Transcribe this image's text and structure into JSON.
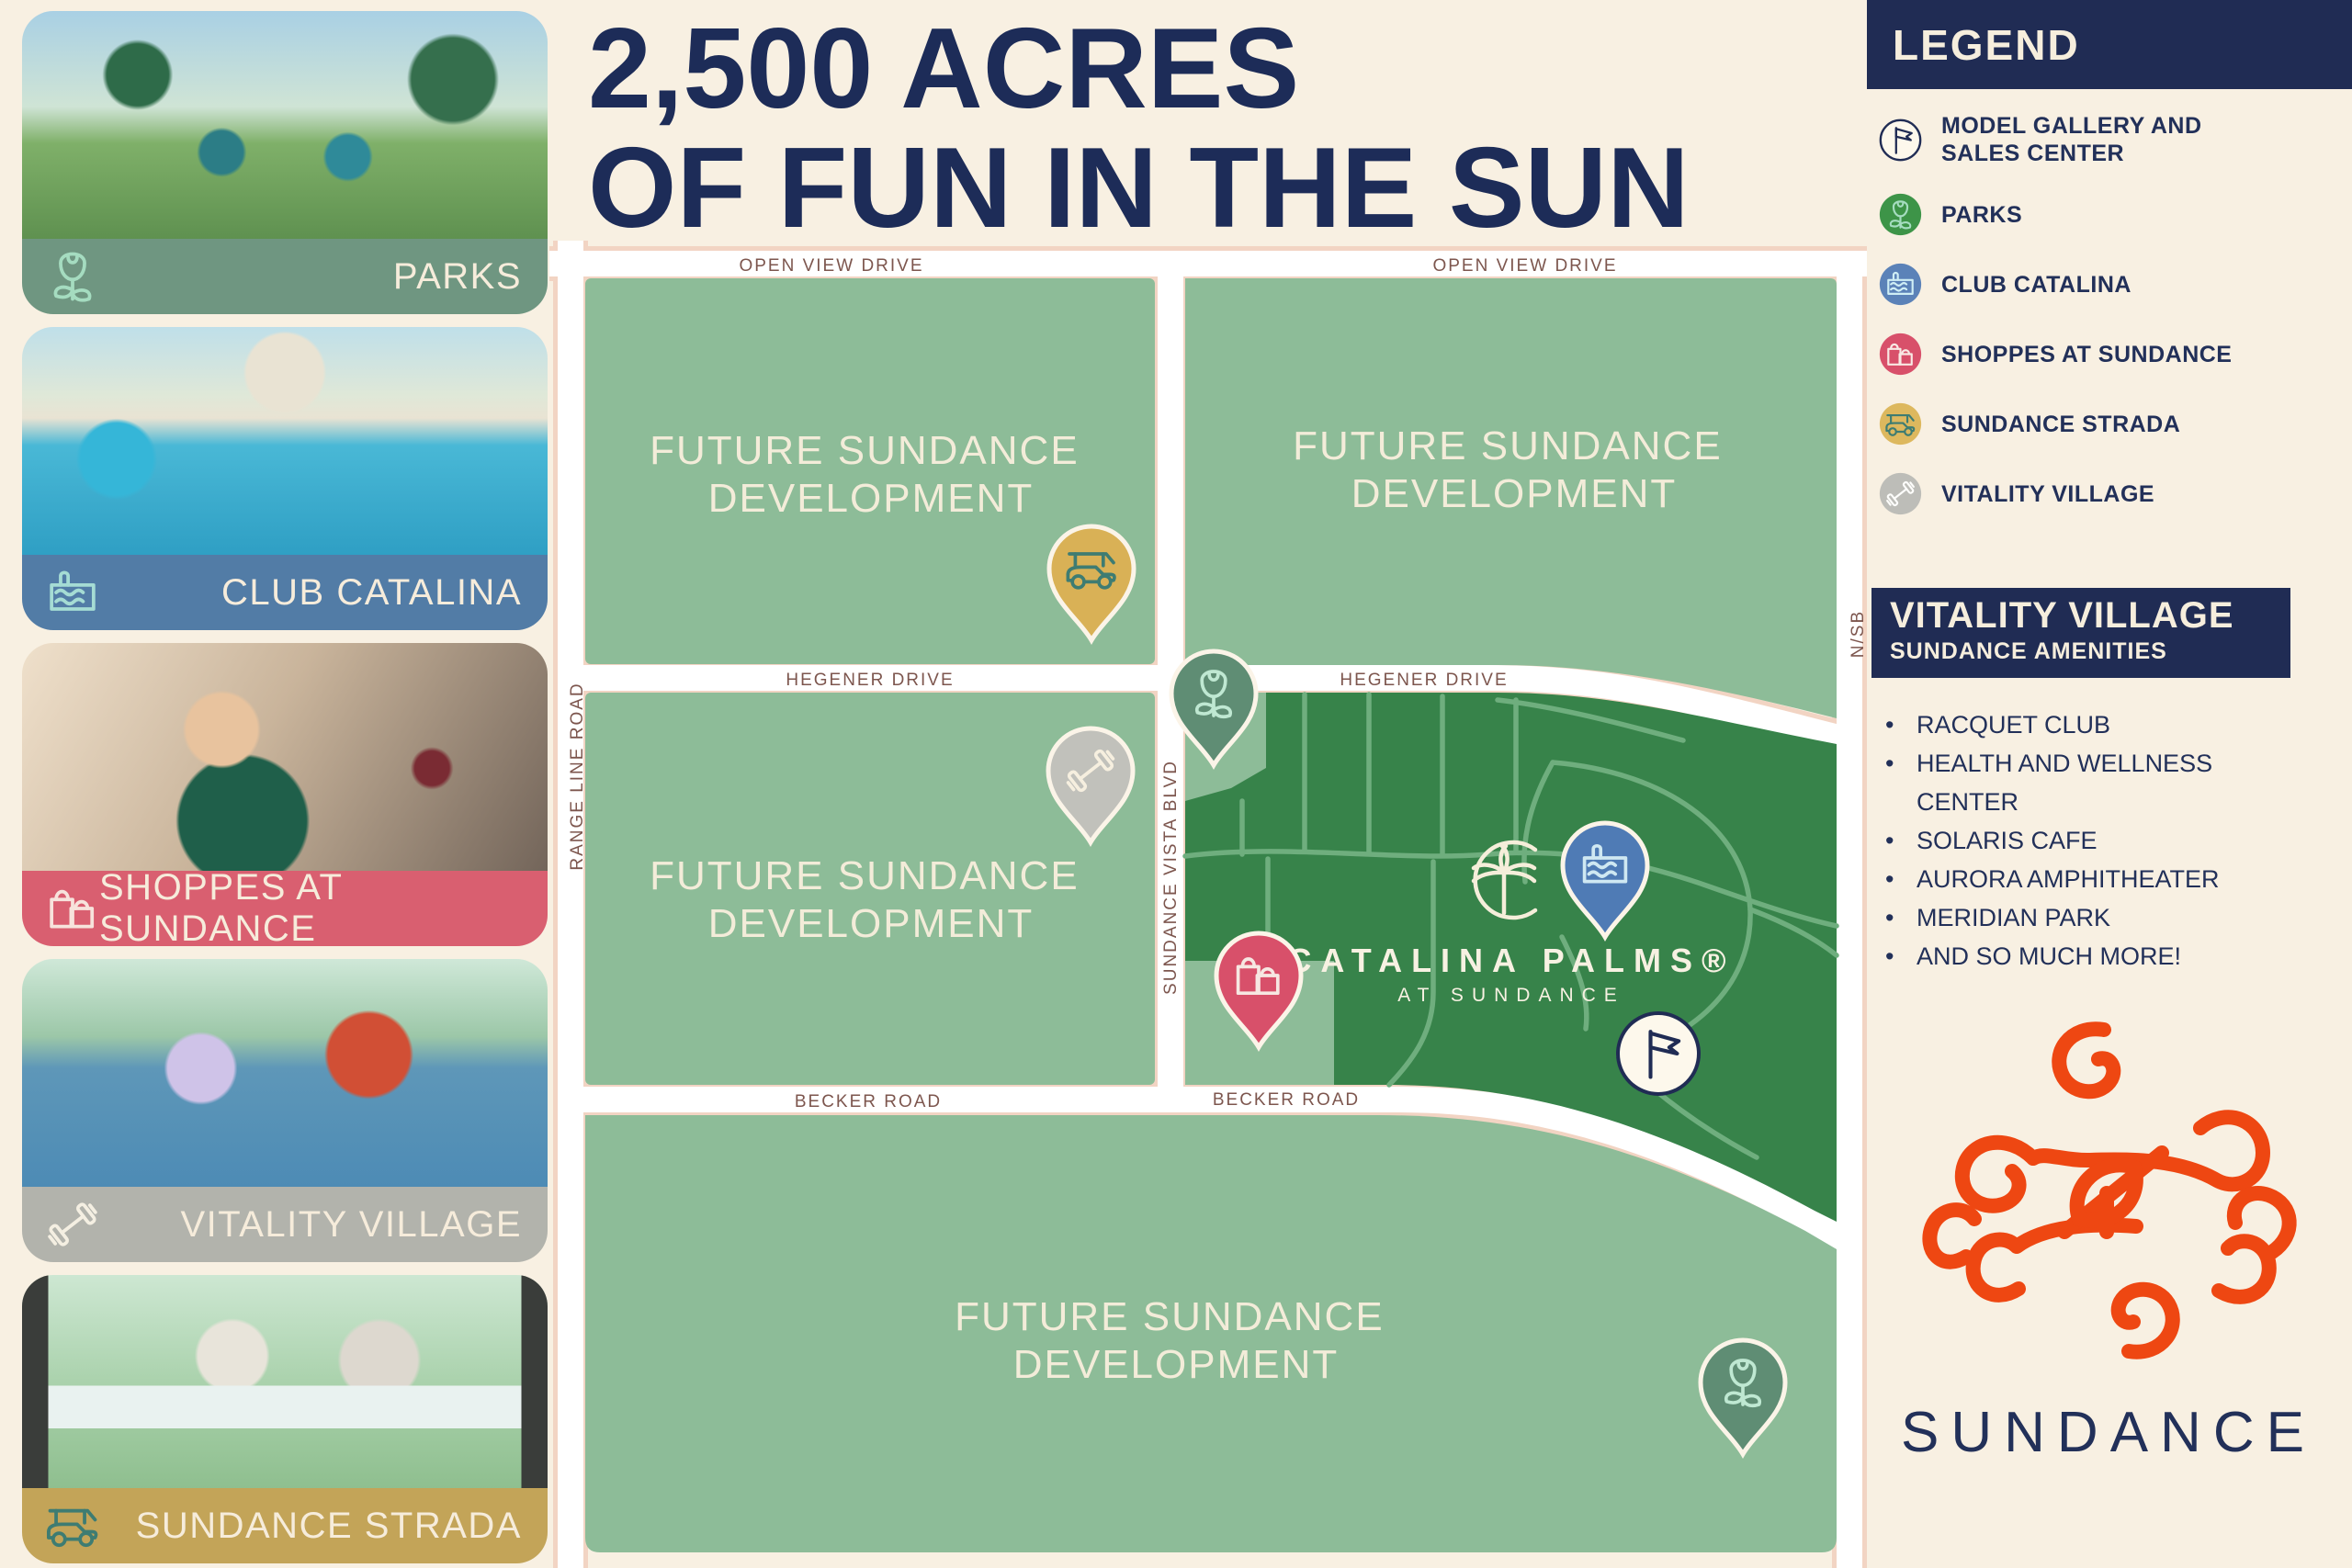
{
  "title": {
    "line1": "2,500 ACRES",
    "line2": "OF FUN IN THE SUN"
  },
  "cards": [
    {
      "label": "PARKS",
      "icon": "flower-icon",
      "color": "#6f9681"
    },
    {
      "label": "CLUB CATALINA",
      "icon": "pool-icon",
      "color": "#527ca6"
    },
    {
      "label": "SHOPPES AT SUNDANCE",
      "icon": "shopping-bags-icon",
      "color": "#d95f70"
    },
    {
      "label": "VITALITY VILLAGE",
      "icon": "dumbbell-icon",
      "color": "#b2b3ac"
    },
    {
      "label": "SUNDANCE STRADA",
      "icon": "golf-cart-icon",
      "color": "#c3a458"
    }
  ],
  "map": {
    "roads": {
      "open_view": "OPEN VIEW DRIVE",
      "hegener": "HEGENER DRIVE",
      "becker": "BECKER ROAD",
      "range_line": "RANGE LINE ROAD",
      "sundance_vista": "SUNDANCE VISTA BLVD",
      "nsb": "N/SB"
    },
    "parcel_label": {
      "line1": "FUTURE SUNDANCE",
      "line2": "DEVELOPMENT"
    },
    "community": {
      "name": "CATALINA PALMS®",
      "subname": "AT SUNDANCE"
    },
    "colors": {
      "parcel_light": "#8dbc98",
      "parcel_dark": "#37834a",
      "street_line": "#6fae7e",
      "road_edge": "#f2d4c3"
    },
    "pins": {
      "strada": {
        "name": "sundance-strada-pin",
        "color": "#d9b156"
      },
      "park_top": {
        "name": "park-pin",
        "color": "#5f8d74"
      },
      "vitality": {
        "name": "vitality-village-pin",
        "color": "#c1c1bb"
      },
      "club": {
        "name": "club-catalina-pin",
        "color": "#4f7bb5"
      },
      "shoppes": {
        "name": "shoppes-pin",
        "color": "#d8506a"
      },
      "park_bot": {
        "name": "park-pin-south",
        "color": "#5f8d74"
      },
      "gallery": {
        "name": "model-gallery-marker",
        "color": "#fdf8ec"
      }
    }
  },
  "legend": {
    "title": "LEGEND",
    "items": [
      {
        "label": "MODEL GALLERY AND SALES CENTER",
        "icon": "flag-icon",
        "color": "#fdf8ec"
      },
      {
        "label": "PARKS",
        "icon": "flower-icon",
        "color": "#3d9448"
      },
      {
        "label": "CLUB CATALINA",
        "icon": "pool-icon",
        "color": "#5b82b8"
      },
      {
        "label": "SHOPPES AT SUNDANCE",
        "icon": "shopping-bags-icon",
        "color": "#d8506a"
      },
      {
        "label": "SUNDANCE STRADA",
        "icon": "golf-cart-icon",
        "color": "#ddb85e"
      },
      {
        "label": "VITALITY VILLAGE",
        "icon": "dumbbell-icon",
        "color": "#bdbdb8"
      }
    ]
  },
  "vitality": {
    "heading": "VITALITY VILLAGE",
    "subheading": "SUNDANCE AMENITIES",
    "items": [
      "RACQUET CLUB",
      "HEALTH AND WELLNESS CENTER",
      "SOLARIS CAFE",
      "AURORA AMPHITHEATER",
      "MERIDIAN PARK",
      "AND SO MUCH MORE!"
    ]
  },
  "brand": {
    "wordmark": "SUNDANCE",
    "accent": "#ee4712",
    "navy": "#202c54",
    "cream": "#f8f0e2"
  }
}
